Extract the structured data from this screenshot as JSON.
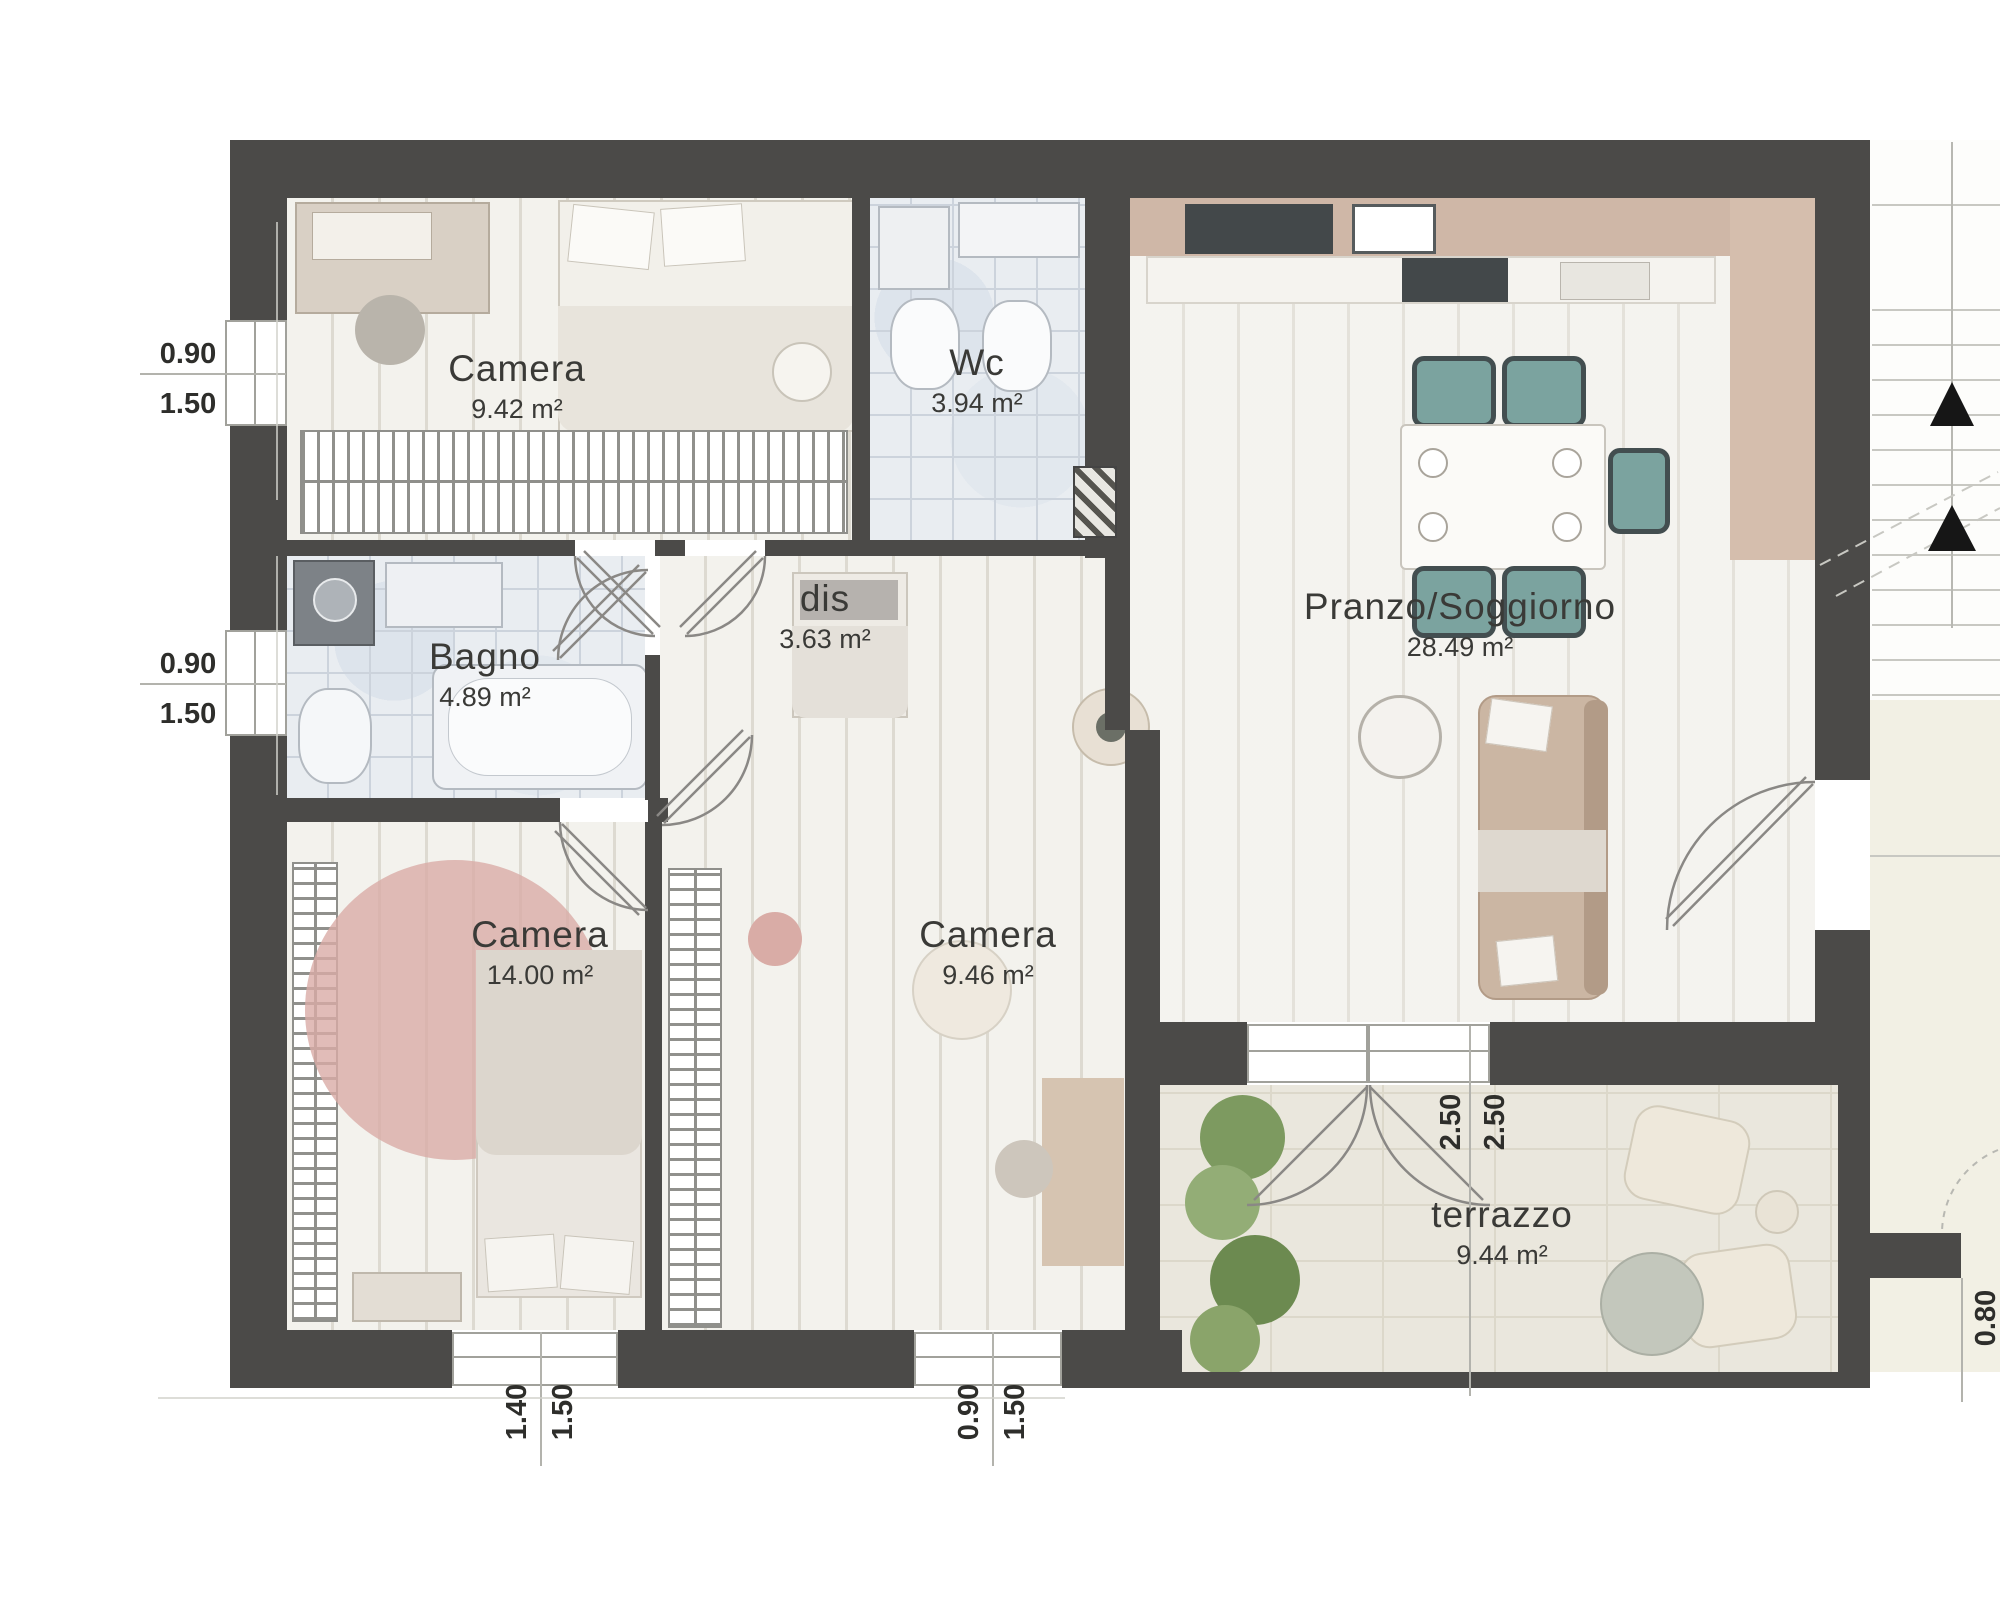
{
  "plan_title": "Apartment floor plan",
  "palette": {
    "wall": "#4b4a48",
    "wood_floor": "#edebe4",
    "living_floor": "#f0eee8",
    "bath_tile": "#e9edf1",
    "terrace_floor": "#eae7dd",
    "kitchen_band": "#cfb7a7",
    "rug_pink": "#d9aba6",
    "chair_teal": "#7ba39f",
    "plant_green": "#7d9a60",
    "label_text": "#3a3a37"
  },
  "rooms": [
    {
      "id": "camera-nord",
      "name": "Camera",
      "area": "9.42 m²"
    },
    {
      "id": "wc",
      "name": "Wc",
      "area": "3.94 m²"
    },
    {
      "id": "pranzo-soggiorno",
      "name": "Pranzo/Soggiorno",
      "area": "28.49 m²"
    },
    {
      "id": "bagno",
      "name": "Bagno",
      "area": "4.89 m²"
    },
    {
      "id": "dis",
      "name": "dis",
      "area": "3.63 m²"
    },
    {
      "id": "camera-ovest",
      "name": "Camera",
      "area": "14.00 m²"
    },
    {
      "id": "camera-sud",
      "name": "Camera",
      "area": "9.46 m²"
    },
    {
      "id": "terrazzo",
      "name": "terrazzo",
      "area": "9.44 m²"
    }
  ],
  "dimensions": [
    {
      "id": "left-upper-window",
      "values": [
        "0.90",
        "1.50"
      ]
    },
    {
      "id": "left-lower-window",
      "values": [
        "0.90",
        "1.50"
      ]
    },
    {
      "id": "bottom-left-window",
      "values": [
        "1.40",
        "1.50"
      ]
    },
    {
      "id": "bottom-mid-window",
      "values": [
        "0.90",
        "1.50"
      ]
    },
    {
      "id": "terrace-opening",
      "values": [
        "2.50",
        "2.50"
      ]
    },
    {
      "id": "right-edge",
      "values": [
        "0.80"
      ]
    }
  ]
}
